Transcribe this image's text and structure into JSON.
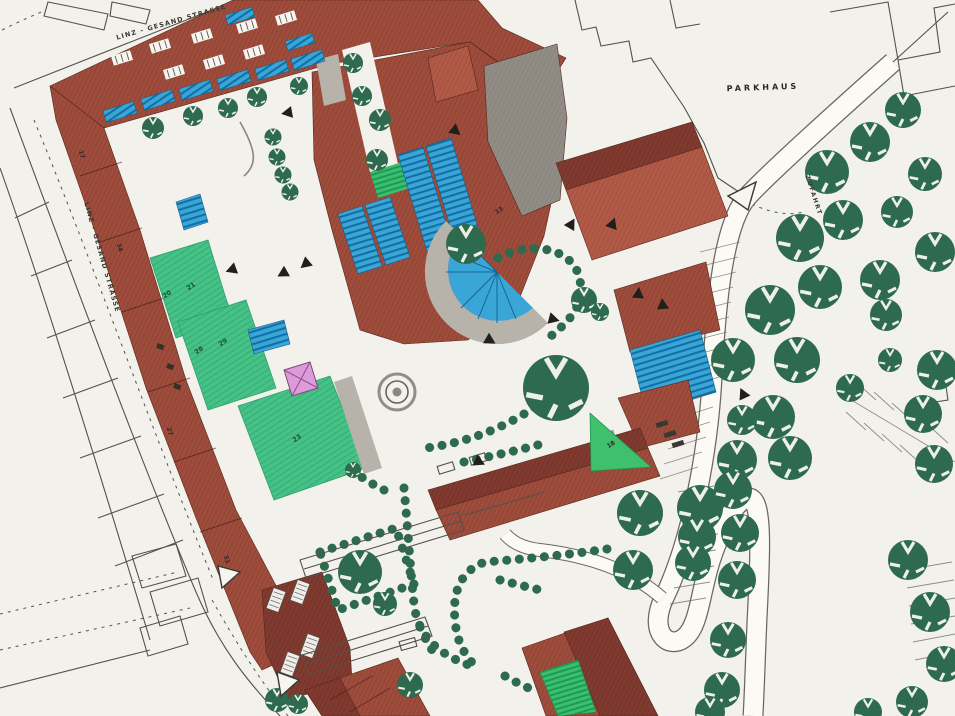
{
  "labels": {
    "street_top": "LINZ - GESAND STRASSE",
    "street_left": "LINZ - GESAND STRASSE",
    "parkhaus": "PARKHAUS",
    "zufahrt": "ZUFAHRT"
  },
  "building_numbers": {
    "b17": "17",
    "b34": "34",
    "b27": "27",
    "b31": "31",
    "b20": "20",
    "b21": "21",
    "b28": "28",
    "b29": "29",
    "b23": "23",
    "b13": "13",
    "b18": "18"
  },
  "colors": {
    "paper": "#f2f1eb",
    "brick": "#9e4c3c",
    "brick_dark": "#803a2f",
    "brick_light": "#b05a47",
    "roof_blue": "#3aa6d8",
    "lawn_green": "#45c287",
    "bright_green": "#3ec06d",
    "tree_green": "#2d6a4e",
    "gray_building": "#918c85",
    "stair_gray": "#b7b3aa",
    "pink_canopy": "#dd9cd9",
    "outline": "#54514a"
  }
}
